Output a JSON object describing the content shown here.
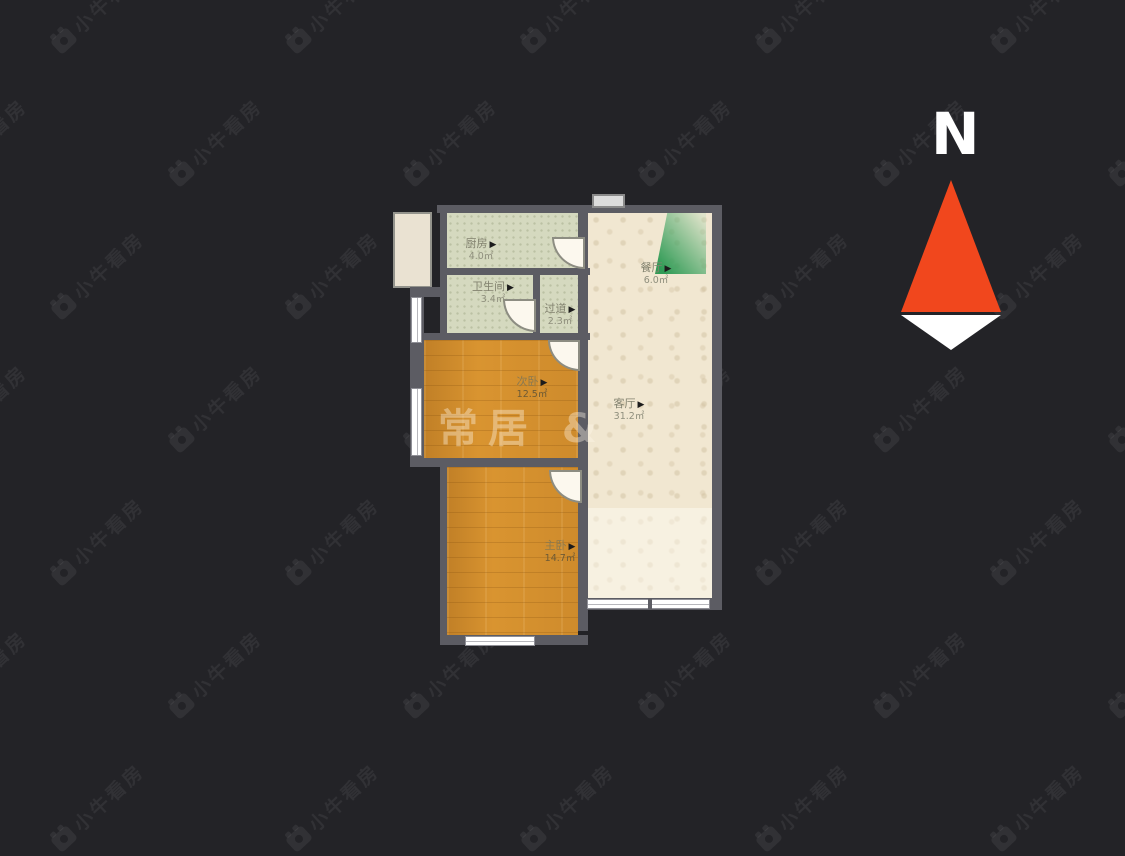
{
  "scene": {
    "type": "residential floor plan",
    "background": "#232327"
  },
  "compass": {
    "label": "N",
    "needle_color": "#f1471d",
    "needle_tail_color": "#ffffff"
  },
  "watermarks": {
    "tile_text": "小牛看房",
    "plan_text": "常居 &"
  },
  "ui": {
    "arrow": "▶"
  },
  "palette": {
    "wall": "#5c5c63",
    "wood_floor": "#d99430",
    "tile_floor": "#d5d9bf",
    "living_floor": "#f1e7d1",
    "light_cone_green": "#2f9b55"
  },
  "rooms": [
    {
      "name": "厨房",
      "area": "4.0㎡"
    },
    {
      "name": "卫生间",
      "area": "3.4㎡"
    },
    {
      "name": "过道",
      "area": "2.3㎡"
    },
    {
      "name": "次卧",
      "area": "12.5㎡"
    },
    {
      "name": "主卧",
      "area": "14.7㎡"
    },
    {
      "name": "客厅",
      "area": "31.2㎡"
    },
    {
      "name": "餐厅",
      "area": "6.0㎡"
    }
  ]
}
